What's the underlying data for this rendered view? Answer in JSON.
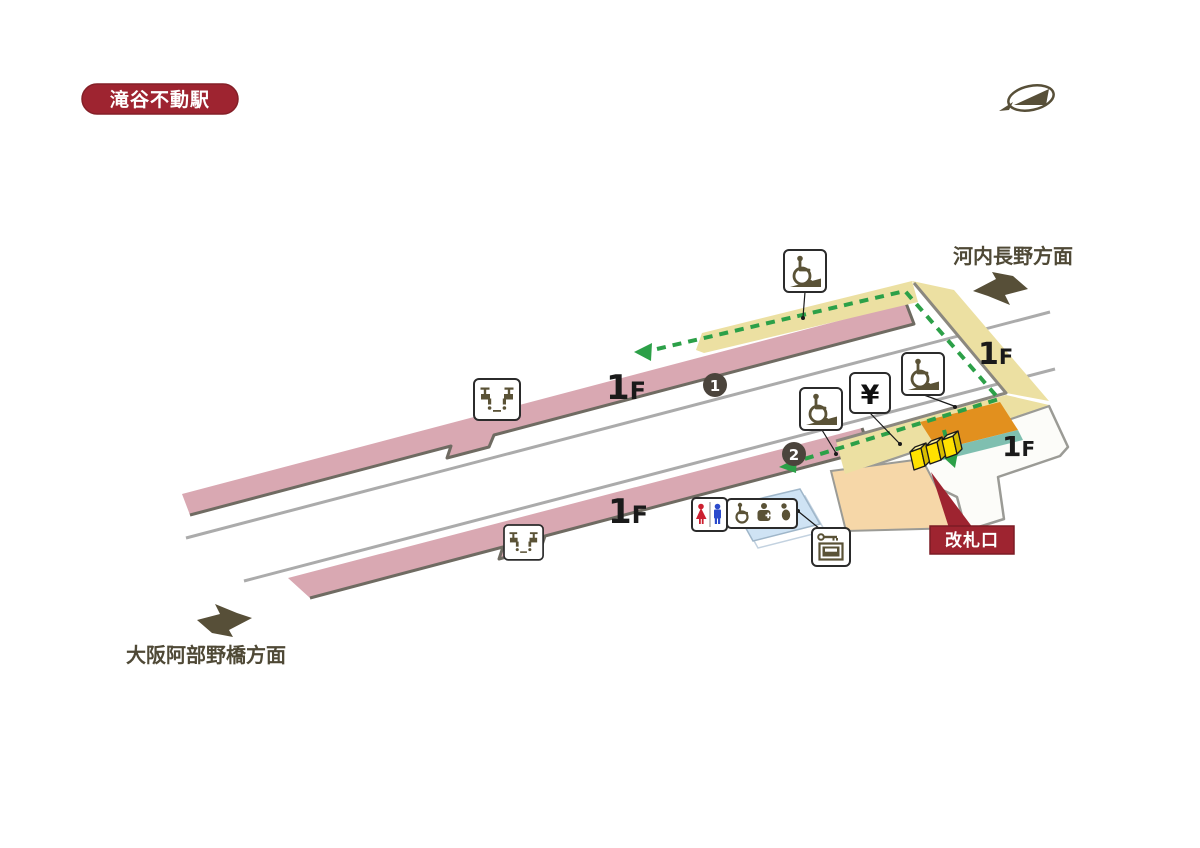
{
  "station_badge": {
    "label": "滝谷不動駅"
  },
  "directions": {
    "kawachinagano": "河内長野方面",
    "osaka_abenobashi": "大阪阿部野橋方面"
  },
  "floor": {
    "num": "1",
    "suffix": "F"
  },
  "tracks": {
    "track1": "1",
    "track2": "2"
  },
  "gate": {
    "label": "改札口"
  },
  "labels": {
    "yen": "¥"
  },
  "icon_names": [
    "railway-logo",
    "wheelchair-ramp-icon",
    "drinking-fountain-icon",
    "fare-machine-icon",
    "restroom-icon",
    "multipurpose-toilet-icon",
    "coin-locker-icon",
    "ticket-gates",
    "route-dashed-arrow"
  ],
  "colors": {
    "platform_pink": "#d9a8b2",
    "ramp_khaki": "#ece0a2",
    "building_orange": "#e2901e",
    "building_teal": "#7fbfb0",
    "peach": "#f6d7a8",
    "toilet_blue": "#cfe3f4",
    "route_green": "#2ca048",
    "accent_red": "#9e2430",
    "gate_yellow": "#ffe100",
    "arrow_olive": "#574f38"
  }
}
